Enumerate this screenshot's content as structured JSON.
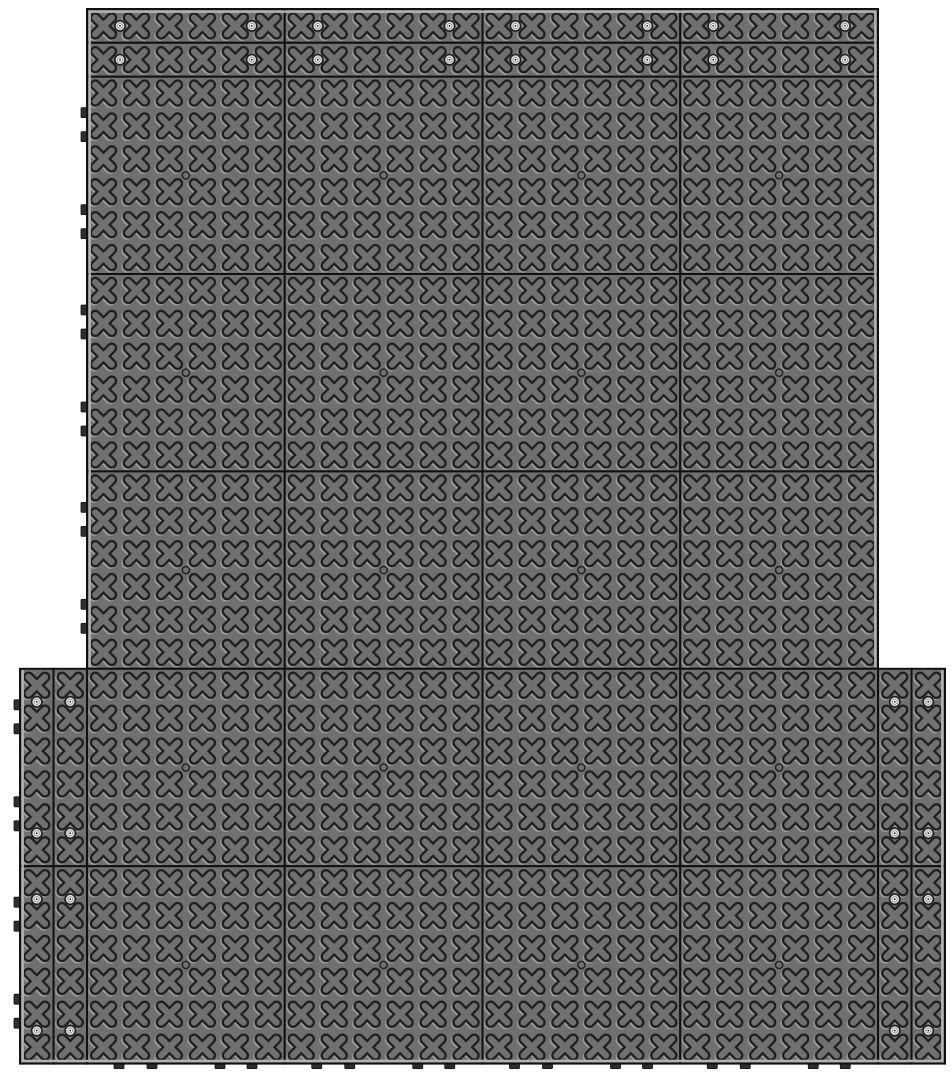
{
  "drawing": {
    "canvas": {
      "w": 952,
      "h": 1078,
      "bg": "#ffffff"
    },
    "colors": {
      "tile_fill": "#707070",
      "outline_dark": "#1f1f1f",
      "border_dark": "#111111",
      "emboss_light": "#9a9a9a",
      "edge_light": "#b2b2b2",
      "tab_fill": "#2e2e2e",
      "screw_ring": "#d6d6d6",
      "screw_center": "#fafafa",
      "screw_dot": "#1a1a1a"
    },
    "field": {
      "x": 87,
      "y": 76.6,
      "cols": 4,
      "rows": 5,
      "tile_w": 197.75,
      "tile_h": 197.4,
      "cells": 6,
      "full_width_rows": [
        0,
        1,
        2
      ],
      "extended_rows": [
        3,
        4
      ]
    },
    "top_strips": {
      "x": 87,
      "y": 9,
      "h": 33.8,
      "rows": 2,
      "segments": 4
    },
    "side_strips": {
      "w": 33.5,
      "left_x": [
        20,
        53.5
      ],
      "right_x": [
        878,
        911.5
      ],
      "row_start": 3,
      "row_count": 2
    },
    "screw_inset": 33,
    "center_hole_r": 3.6,
    "motif": {
      "bar_half": 8.2,
      "bar_w": 11,
      "inner_w": 6.4,
      "emboss_dx": -1.4,
      "emboss_dy": 1.4
    },
    "tabs": {
      "side_w": 6,
      "side_h": 10,
      "side_offsets": [
        36,
        60,
        133,
        157
      ],
      "bottom_w": 10,
      "bottom_h": 5,
      "bottom_offsets": [
        32,
        65,
        133,
        165
      ]
    },
    "composition": {
      "full_tiles": 20,
      "top_edge_strip_segments": 8,
      "side_edge_strip_segments": 8,
      "screws": 32,
      "x_motifs_per_tile": 36
    }
  }
}
